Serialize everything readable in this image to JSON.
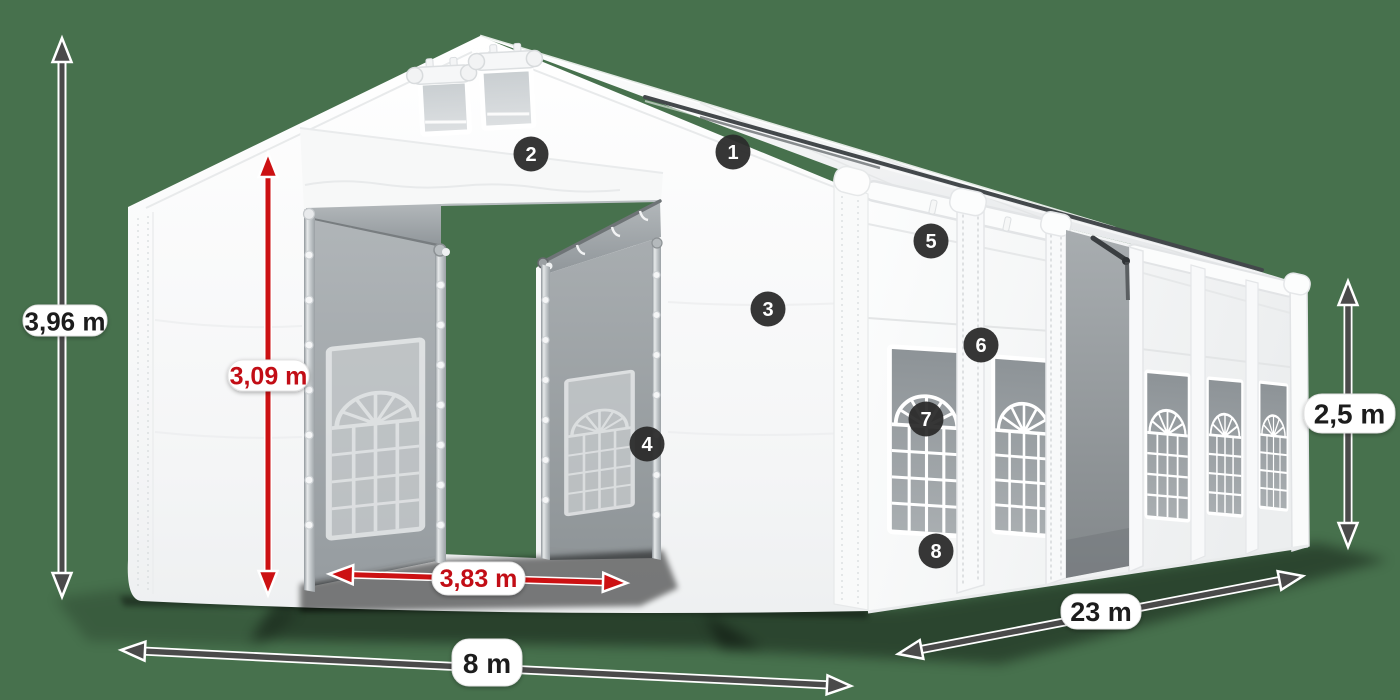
{
  "dimensions": {
    "total_height": {
      "label": "3,96 m",
      "color": "#4a4a4a"
    },
    "entrance_height": {
      "label": "3,09 m",
      "color": "#cc1113"
    },
    "entrance_width": {
      "label": "3,83 m",
      "color": "#cc1113"
    },
    "total_width": {
      "label": "8 m",
      "color": "#4a4a4a"
    },
    "total_length": {
      "label": "23 m",
      "color": "#4a4a4a"
    },
    "side_height": {
      "label": "2,5 m",
      "color": "#4a4a4a"
    }
  },
  "hotspots": [
    {
      "number": "1"
    },
    {
      "number": "2"
    },
    {
      "number": "3"
    },
    {
      "number": "4"
    },
    {
      "number": "5"
    },
    {
      "number": "6"
    },
    {
      "number": "7"
    },
    {
      "number": "8"
    }
  ],
  "colors": {
    "background": "#47714D",
    "tent_white": "#f7f8f8",
    "interior_gray": "#a3a8ab",
    "arrow_dark": "#4a4a4a",
    "arrow_red": "#cc1113",
    "label_pill": "#ffffff",
    "badge": "#2b2b2b"
  }
}
